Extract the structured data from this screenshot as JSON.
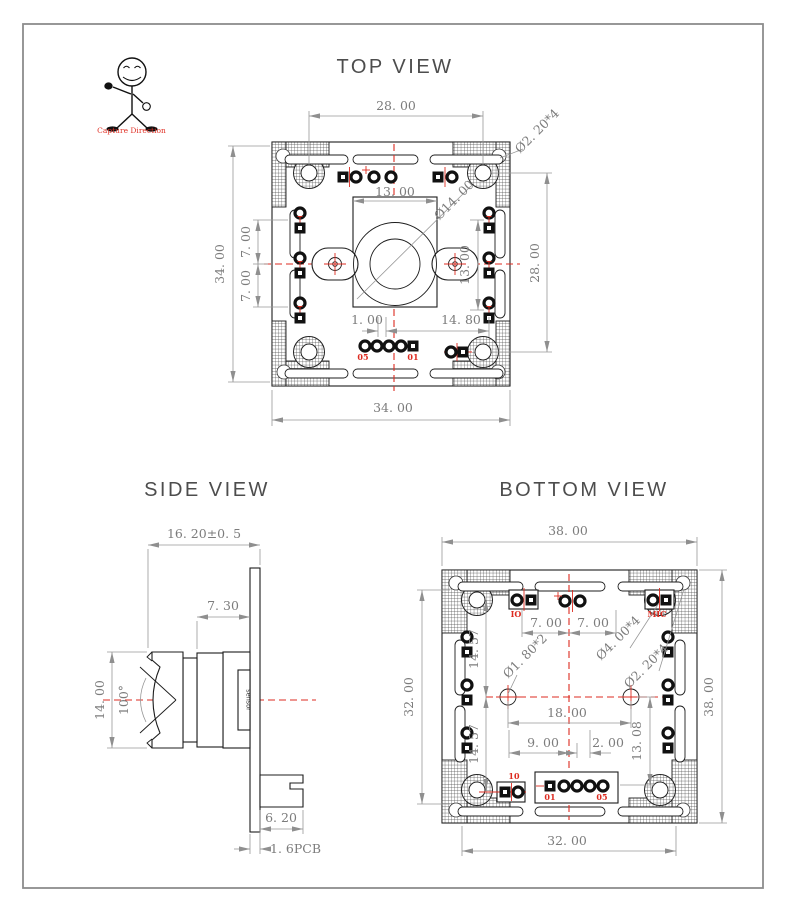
{
  "colors": {
    "line": "#1c1c1c",
    "dimension": "#979797",
    "dimension_text": "#7c7c7c",
    "accent_red": "#dd2b20",
    "title_gray": "#4d4d4d",
    "background": "#ffffff"
  },
  "figure": {
    "caption": "Capture Direction"
  },
  "views": {
    "top": {
      "title": "TOP VIEW",
      "dims": {
        "top_width": "28. 00",
        "hole_dia": "Ø2. 20*4",
        "lens_w": "13. 00",
        "lens_dia": "Ø14. 00",
        "left_h": "34. 00",
        "pitch_a": "7. 00",
        "pitch_b": "7. 00",
        "lens_h": "13. 00",
        "right_h": "28. 00",
        "off_a": "1. 00",
        "off_b": "14. 80",
        "bottom_w": "34. 00"
      },
      "labels": {
        "pin_left": "05",
        "pin_right": "01"
      }
    },
    "side": {
      "title": "SIDE VIEW",
      "dims": {
        "total_depth": "16. 20±0. 5",
        "holder_depth": "7. 30",
        "lens_dia": "14. 00",
        "fov": "100°",
        "connector_w": "6. 20",
        "pcb_thickness": "1. 6PCB"
      },
      "labels": {
        "sensor": "sensor"
      }
    },
    "bottom": {
      "title": "BOTTOM  VIEW",
      "dims": {
        "top_w": "38. 00",
        "right_h": "38. 00",
        "left_h": "32. 00",
        "bottom_w": "32. 00",
        "pad_a": "7. 00",
        "pad_b": "7. 00",
        "seg_a": "14. 57",
        "seg_b": "14. 57",
        "hole_center": "Ø1. 80*2",
        "hole_big": "Ø4. 00*4",
        "hole_small": "Ø2. 20*4",
        "hole_span": "18. 00",
        "conn_a": "9. 00",
        "conn_b": "2. 00",
        "conn_h": "13. 08"
      },
      "labels": {
        "io": "IO",
        "mic": "MIC",
        "io2": "10",
        "pin_left": "01",
        "pin_right": "05"
      }
    }
  }
}
